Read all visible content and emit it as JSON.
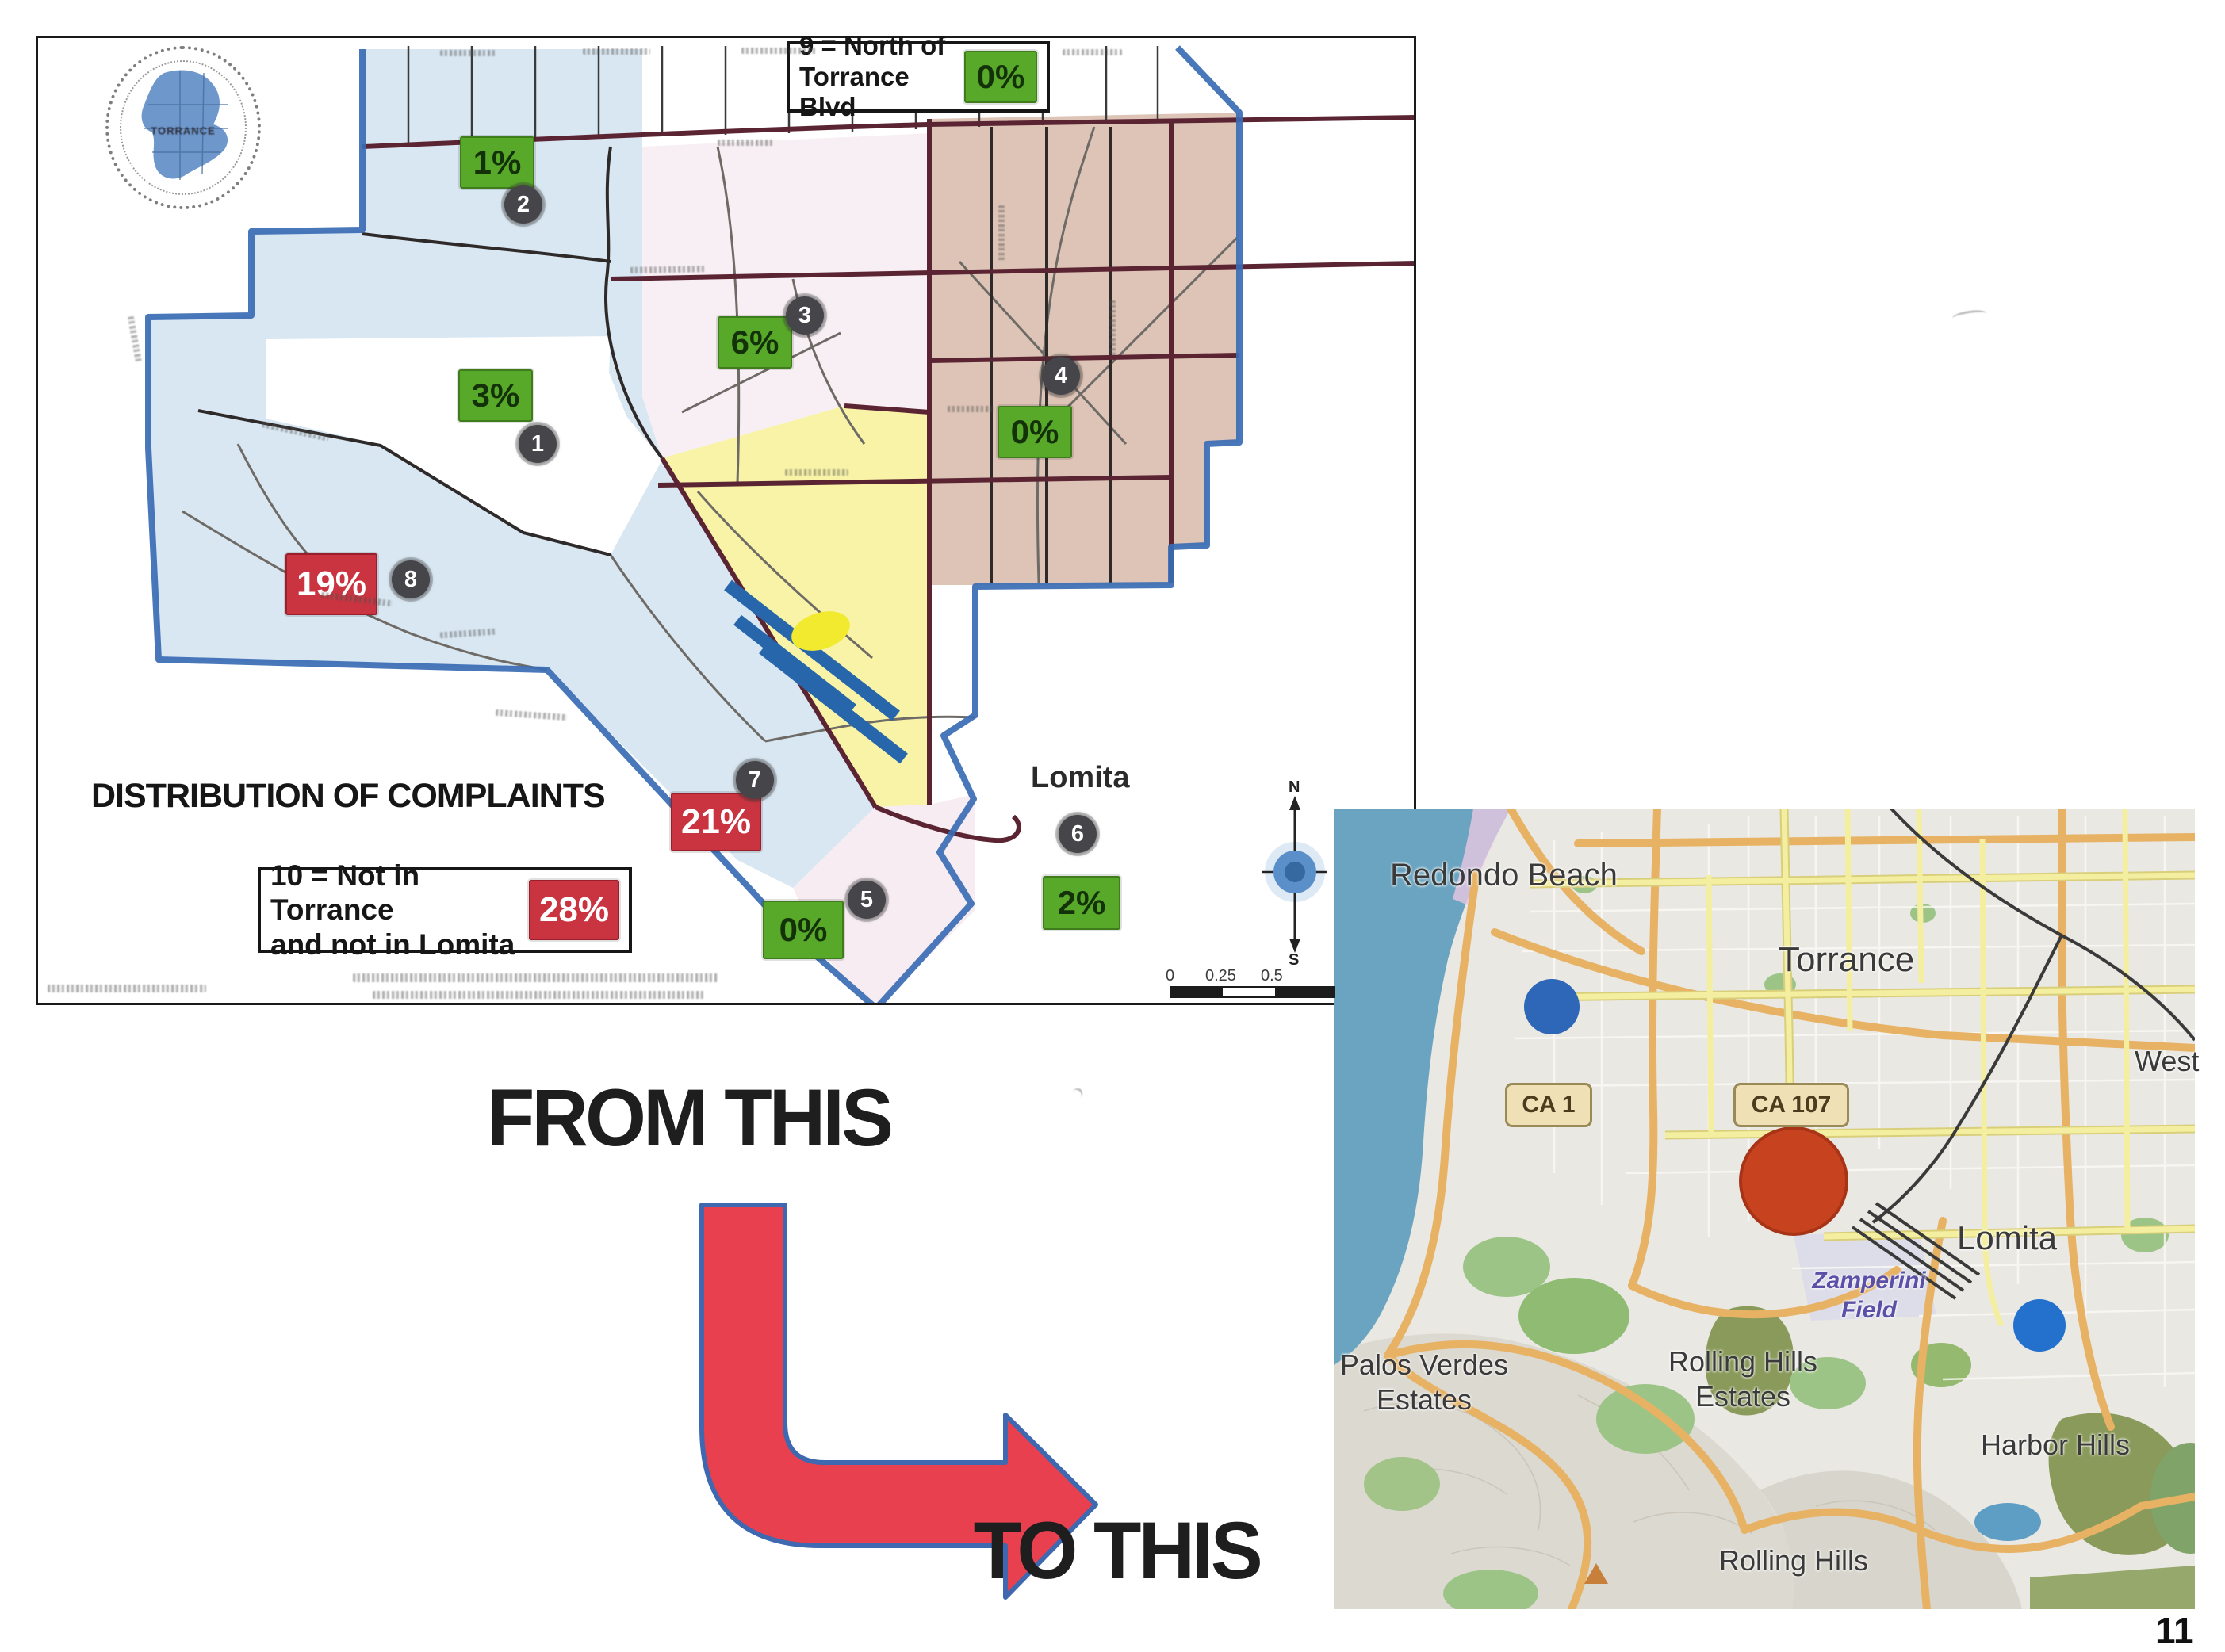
{
  "map1": {
    "title": "DISTRIBUTION OF COMPLAINTS",
    "seal_text": "TORRANCE",
    "lomita_label": "Lomita",
    "note9": {
      "line1": "9 = North of",
      "line2": "Torrance Blvd",
      "value": "0%"
    },
    "note10": {
      "line1": "10 = Not in Torrance",
      "line2": "and not in Lomita",
      "value": "28%"
    },
    "badges": {
      "d1": "3%",
      "d2": "1%",
      "d3": "6%",
      "d4": "0%",
      "d5": "0%",
      "d6": "2%",
      "d7": "21%",
      "d8": "19%"
    },
    "markers": {
      "m1": "1",
      "m2": "2",
      "m3": "3",
      "m4": "4",
      "m5": "5",
      "m6": "6",
      "m7": "7",
      "m8": "8"
    },
    "compass": {
      "north": "N",
      "south": "S"
    },
    "scale_labels": [
      "0",
      "0.25",
      "0.5"
    ]
  },
  "transition": {
    "from_label": "FROM THIS",
    "to_label": "TO THIS"
  },
  "map2": {
    "place_labels": {
      "redondo_beach": "Redondo Beach",
      "torrance": "Torrance",
      "west": "West",
      "lomita": "Lomita",
      "palos_verdes_line1": "Palos Verdes",
      "palos_verdes_line2": "Estates",
      "rhe_line1": "Rolling Hills",
      "rhe_line2": "Estates",
      "harbor_hills": "Harbor Hills",
      "rolling_hills": "Rolling Hills",
      "zamperini_line1": "Zamperini",
      "zamperini_line2": "Field"
    },
    "shields": {
      "ca1": "CA 1",
      "ca107": "CA 107"
    },
    "page_number": "11"
  },
  "colors": {
    "green_badge": "#58a82a",
    "red_badge": "#c93440",
    "zone_blue": "#d9e7f2",
    "zone_pink": "#f7eff3",
    "zone_tan": "#ddc4b6",
    "zone_yellow": "#f8f3a6",
    "zone_south_pink": "#f6ecf1",
    "boundary_blue": "#3a6cb4",
    "road_maroon": "#5b2433",
    "runway_blue": "#2766ab",
    "ocean": "#6ba4c0",
    "road_yellow": "#f4efa0",
    "road_orange": "#e7b264",
    "red_circle": "#c7421f",
    "blue_dot": "#2e66b8",
    "arrow_red": "#e8404f",
    "arrow_outline": "#3e68b0"
  }
}
